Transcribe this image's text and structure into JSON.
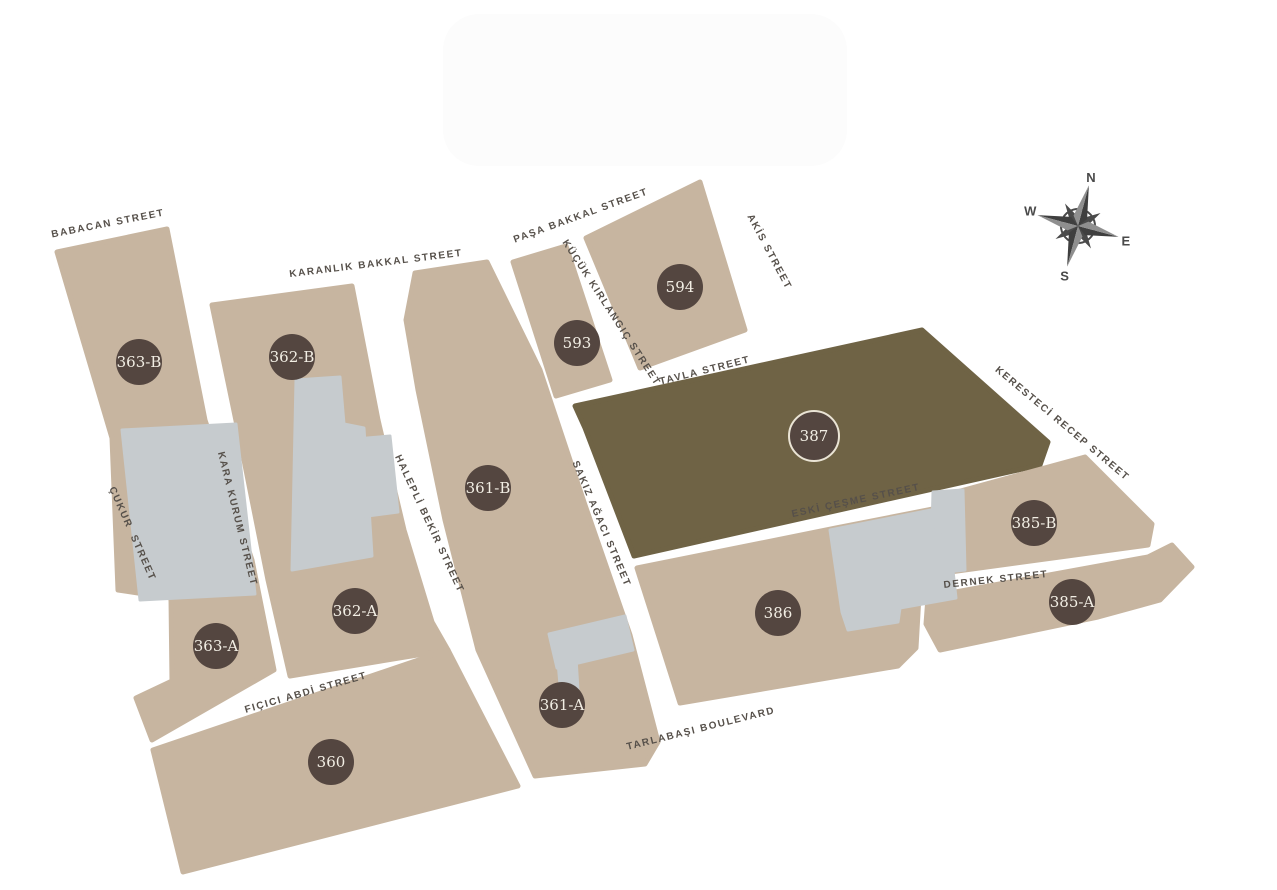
{
  "colors": {
    "block_tan": "#c7b5a0",
    "block_olive": "#6f6345",
    "badge_background": "#544640",
    "badge_text": "#f2eee4",
    "building_gray": "#c6cbce",
    "street_text": "#56504a",
    "compass": "#4a4a4a"
  },
  "compass": {
    "n": "N",
    "e": "E",
    "s": "S",
    "w": "W"
  },
  "blocks": [
    {
      "id": "363-B",
      "x": 139,
      "y": 362
    },
    {
      "id": "362-B",
      "x": 292,
      "y": 357
    },
    {
      "id": "593",
      "x": 577,
      "y": 343
    },
    {
      "id": "594",
      "x": 680,
      "y": 287
    },
    {
      "id": "387",
      "x": 814,
      "y": 436,
      "ring": true
    },
    {
      "id": "361-B",
      "x": 488,
      "y": 488
    },
    {
      "id": "362-A",
      "x": 355,
      "y": 611
    },
    {
      "id": "363-A",
      "x": 216,
      "y": 646
    },
    {
      "id": "385-B",
      "x": 1034,
      "y": 523
    },
    {
      "id": "385-A",
      "x": 1072,
      "y": 602
    },
    {
      "id": "386",
      "x": 778,
      "y": 613
    },
    {
      "id": "361-A",
      "x": 562,
      "y": 705
    },
    {
      "id": "360",
      "x": 331,
      "y": 762
    }
  ],
  "streets": [
    {
      "name": "BABACAN STREET",
      "x": 108,
      "y": 224,
      "angle": -11
    },
    {
      "name": "KARANLIK BAKKAL STREET",
      "x": 376,
      "y": 264,
      "angle": -7
    },
    {
      "name": "PAŞA BAKKAL STREET",
      "x": 581,
      "y": 216,
      "angle": -20
    },
    {
      "name": "KÜÇÜK KIRLANGIÇ STREET",
      "x": 611,
      "y": 313,
      "angle": 57
    },
    {
      "name": "AKİS STREET",
      "x": 769,
      "y": 252,
      "angle": 62
    },
    {
      "name": "TAVLA STREET",
      "x": 705,
      "y": 371,
      "angle": -14
    },
    {
      "name": "KERESTECİ RECEP STREET",
      "x": 1062,
      "y": 424,
      "angle": 40
    },
    {
      "name": "ÇUKUR  STREET",
      "x": 132,
      "y": 534,
      "angle": 66
    },
    {
      "name": "KARA KURUM STREET",
      "x": 237,
      "y": 519,
      "angle": 76
    },
    {
      "name": "HALEPLİ BEKİR STREET",
      "x": 429,
      "y": 524,
      "angle": 65
    },
    {
      "name": "SAKIZ AĞACI STREET",
      "x": 601,
      "y": 524,
      "angle": 67
    },
    {
      "name": "ESKİ ÇEŞME STREET",
      "x": 856,
      "y": 501,
      "angle": -12
    },
    {
      "name": "DERNEK STREET",
      "x": 996,
      "y": 580,
      "angle": -6
    },
    {
      "name": "FIÇICI ABDİ STREET",
      "x": 306,
      "y": 693,
      "angle": -16
    },
    {
      "name": "TARLABAŞI BOULEVARD",
      "x": 701,
      "y": 729,
      "angle": -14
    }
  ]
}
